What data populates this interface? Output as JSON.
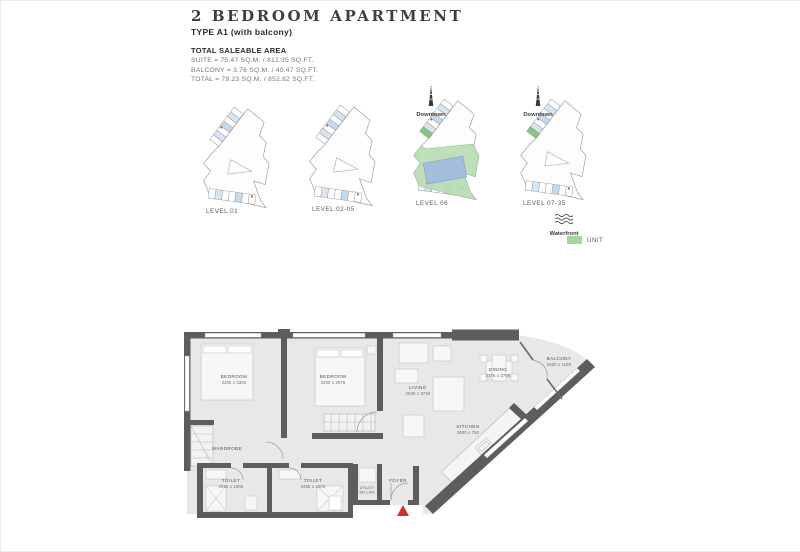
{
  "header": {
    "title": "2 BEDROOM APARTMENT",
    "subtitle": "TYPE A1 (with balcony)",
    "area": {
      "heading": "TOTAL SALEABLE AREA",
      "lines": [
        "SUITE = 75.47 SQ.M. / 812.35 SQ.FT.",
        "BALCONY = 3.76 SQ.M. / 40.47 SQ.FT.",
        "TOTAL = 79.23 SQ.M. / 852.82 SQ.FT."
      ]
    }
  },
  "levels": {
    "items": [
      {
        "label": "LEVEL 01",
        "landmark": ""
      },
      {
        "label": "LEVEL 02-05",
        "landmark": ""
      },
      {
        "label": "LEVEL 06",
        "landmark": "Downtown"
      },
      {
        "label": "LEVEL 07-35",
        "landmark": "Downtown"
      }
    ],
    "waterfront_label": "Waterfront",
    "legend": {
      "unit_label": "UNIT",
      "unit_color": "#a6d3a0"
    }
  },
  "floorplan": {
    "rooms": {
      "bedroom1": {
        "name": "BEDROOM",
        "dims": "3200 x 3300"
      },
      "bedroom2": {
        "name": "BEDROOM",
        "dims": "3200 x 2975"
      },
      "living": {
        "name": "LIVING",
        "dims": "2600 x 3725"
      },
      "dining": {
        "name": "DINING",
        "dims": "2175 x 2700"
      },
      "kitchen": {
        "name": "KITCHEN",
        "dims": "3600 x 750"
      },
      "balcony": {
        "name": "BALCONY",
        "dims": "2600 x 1190"
      },
      "toilet1": {
        "name": "TOILET",
        "dims": "2550 x 1905"
      },
      "toilet2": {
        "name": "TOILET",
        "dims": "2955 x 1500"
      },
      "utility": {
        "name": "UTILITY",
        "dims": "850 x 800"
      },
      "wardrobe": {
        "name": "WARDROBE"
      },
      "foyer": {
        "name": "FOYER"
      }
    },
    "colors": {
      "wall": "#5d5d5d",
      "room_fill": "#e8e8e8",
      "entry_marker": "#d0312d",
      "deck_green": "#b8dcb2",
      "pool_blue": "#a3bedd"
    }
  }
}
